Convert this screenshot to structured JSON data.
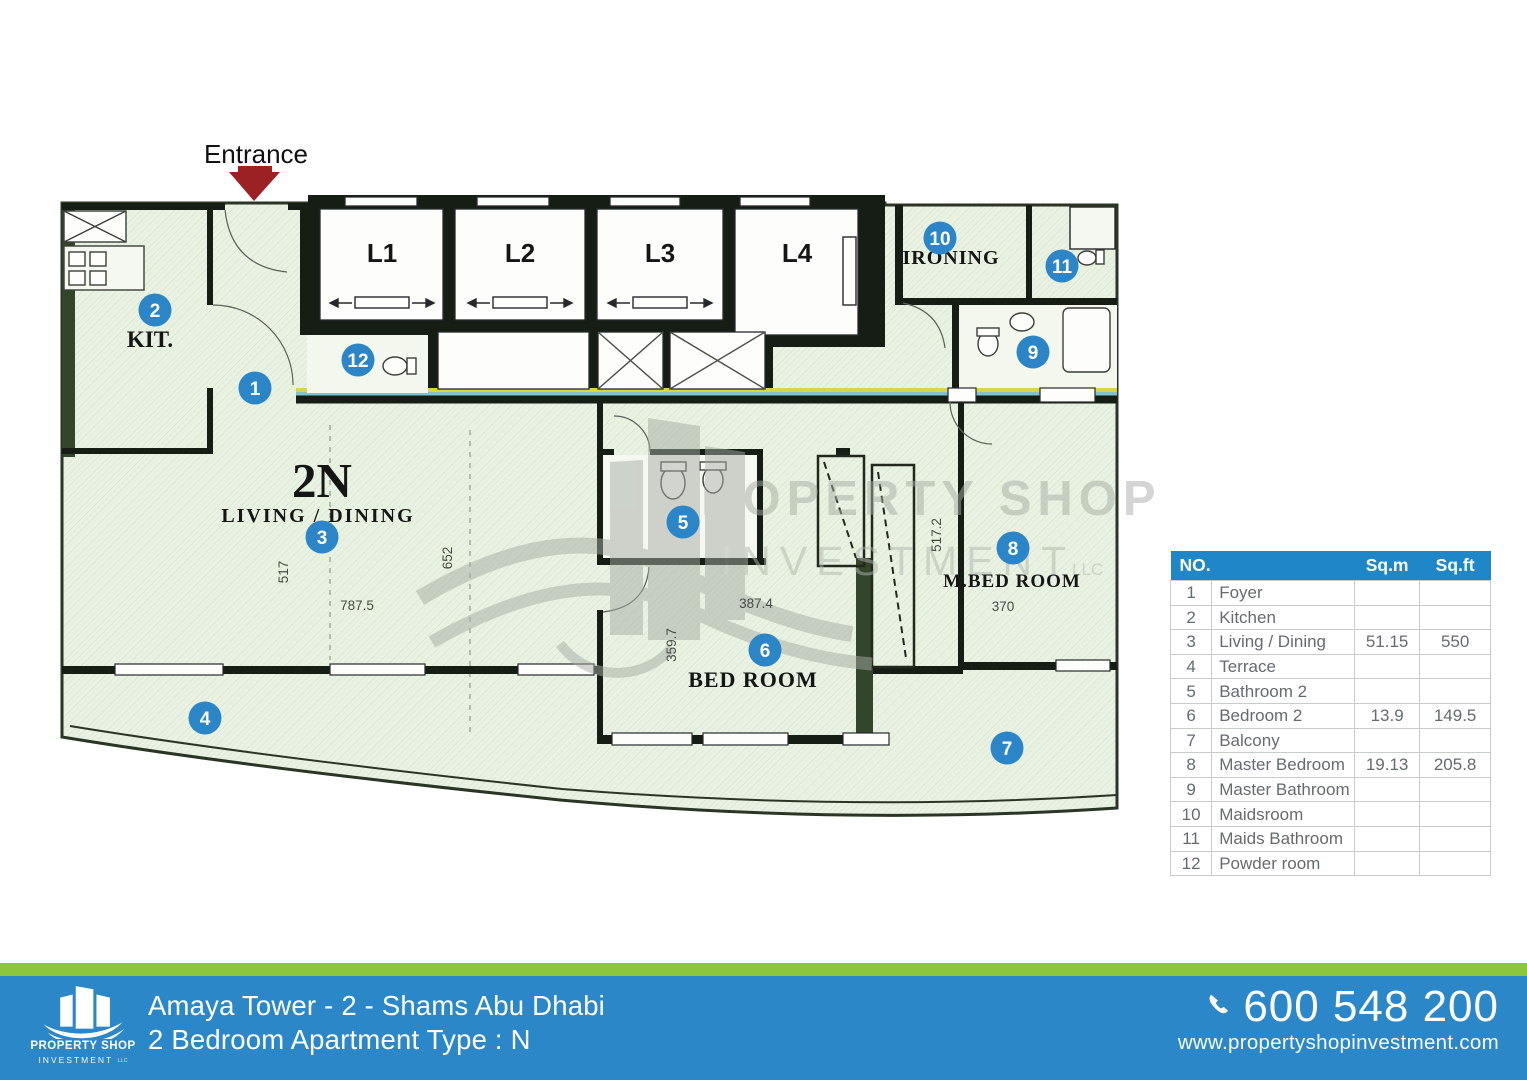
{
  "plan": {
    "entrance_label": "Entrance",
    "unit_code": "2N",
    "rooms": {
      "kitchen": "KIT.",
      "living": "LIVING / DINING",
      "bedroom": "BED ROOM",
      "master": "M.BED ROOM",
      "ironing": "IRONING"
    },
    "lifts": [
      "L1",
      "L2",
      "L3",
      "L4"
    ],
    "dims": {
      "living_w": "787.5",
      "living_h": "517",
      "living_mid": "652",
      "bed_w": "387.4",
      "bed_h": "359.7",
      "master_w": "370",
      "master_h": "517.2"
    },
    "markers": [
      "1",
      "2",
      "3",
      "4",
      "5",
      "6",
      "7",
      "8",
      "9",
      "10",
      "11",
      "12"
    ]
  },
  "watermark": {
    "line1": "PROPERTY SHOP",
    "line2": "INVESTMENT",
    "suffix": "LLC"
  },
  "area_table": {
    "headers": {
      "no": "NO.",
      "sqm": "Sq.m",
      "sqft": "Sq.ft"
    },
    "rows": [
      {
        "no": "1",
        "name": "Foyer",
        "sqm": "",
        "sqft": ""
      },
      {
        "no": "2",
        "name": "Kitchen",
        "sqm": "",
        "sqft": ""
      },
      {
        "no": "3",
        "name": "Living / Dining",
        "sqm": "51.15",
        "sqft": "550"
      },
      {
        "no": "4",
        "name": "Terrace",
        "sqm": "",
        "sqft": ""
      },
      {
        "no": "5",
        "name": "Bathroom 2",
        "sqm": "",
        "sqft": ""
      },
      {
        "no": "6",
        "name": "Bedroom 2",
        "sqm": "13.9",
        "sqft": "149.5"
      },
      {
        "no": "7",
        "name": "Balcony",
        "sqm": "",
        "sqft": ""
      },
      {
        "no": "8",
        "name": "Master Bedroom",
        "sqm": "19.13",
        "sqft": "205.8"
      },
      {
        "no": "9",
        "name": "Master Bathroom",
        "sqm": "",
        "sqft": ""
      },
      {
        "no": "10",
        "name": "Maidsroom",
        "sqm": "",
        "sqft": ""
      },
      {
        "no": "11",
        "name": "Maids Bathroom",
        "sqm": "",
        "sqft": ""
      },
      {
        "no": "12",
        "name": "Powder room",
        "sqm": "",
        "sqft": ""
      }
    ]
  },
  "footer": {
    "logo": {
      "line1": "PROPERTY SHOP",
      "line2": "INVESTMENT",
      "suffix": "LLC"
    },
    "project": "Amaya Tower - 2 - Shams Abu Dhabi",
    "unit": "2 Bedroom Apartment Type : N",
    "phone": "600 548 200",
    "website": "www.propertyshopinvestment.com"
  },
  "colors": {
    "accent_blue": "#2b87c7",
    "table_header_blue": "#1f87c8",
    "green_strip": "#8cc63f",
    "marker_blue": "#2c85c7",
    "plan_fill": "#eaf3e3",
    "wall_black": "#161d14",
    "wall_green": "#33452a",
    "arrow_red": "#9c2125"
  }
}
